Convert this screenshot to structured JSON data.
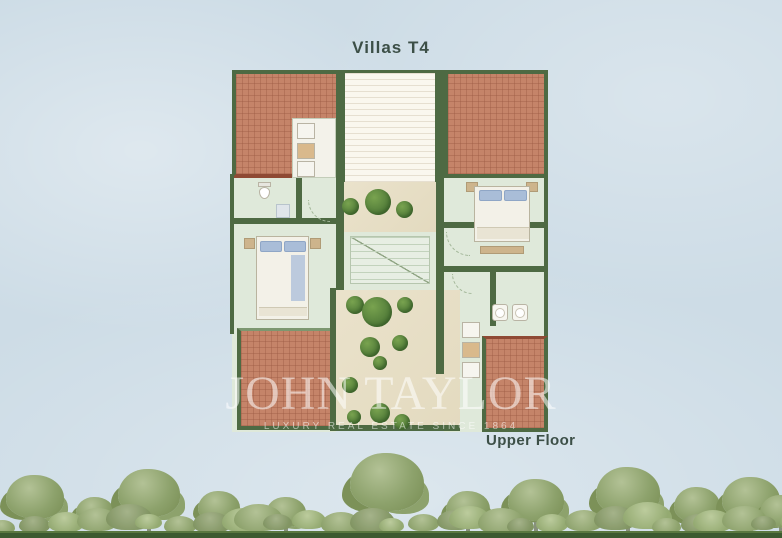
{
  "title": "Villas T4",
  "floor_label": "Upper Floor",
  "watermark": {
    "brand": "JOHN TAYLOR",
    "tagline": "LUXURY REAL ESTATE SINCE 1864"
  },
  "plan": {
    "type": "architectural-floor-plan",
    "unit": "Villas T4",
    "floor": "Upper Floor",
    "rooms_visible": [
      "bedroom-left",
      "bedroom-right",
      "bathroom-left",
      "bathroom-right",
      "laundry-closet",
      "staircase",
      "planted-terrace",
      "courtyard",
      "pergola-roof-terrace",
      "roof-sections"
    ]
  },
  "colors": {
    "sky": "#cddce6",
    "roof": "#c58469",
    "roof_edge": "#8f4a34",
    "wall": "#4e6a43",
    "wall_light": "#7d9770",
    "floor": "#dfe9da",
    "floor_line": "#c2d2bc",
    "pergola": "#faf7ee",
    "pergola_line": "#e6dfd0",
    "courtyard": "#eae2cb",
    "tree_dark": "#4c7636",
    "tree_light": "#79a34f",
    "text": "#3c4f47",
    "watermark": "rgba(255,255,255,0.55)",
    "band_tree": "#8da26c",
    "band_tree_light": "#b3c296",
    "band_tree_dark": "#7c9158",
    "trunk": "#87907b",
    "ground": "#3c5a30",
    "ground_light": "#5a7840",
    "furniture_tan": "#cdb48c",
    "pillow": "#a9bdd8",
    "bed_white": "#f3f1e8"
  }
}
